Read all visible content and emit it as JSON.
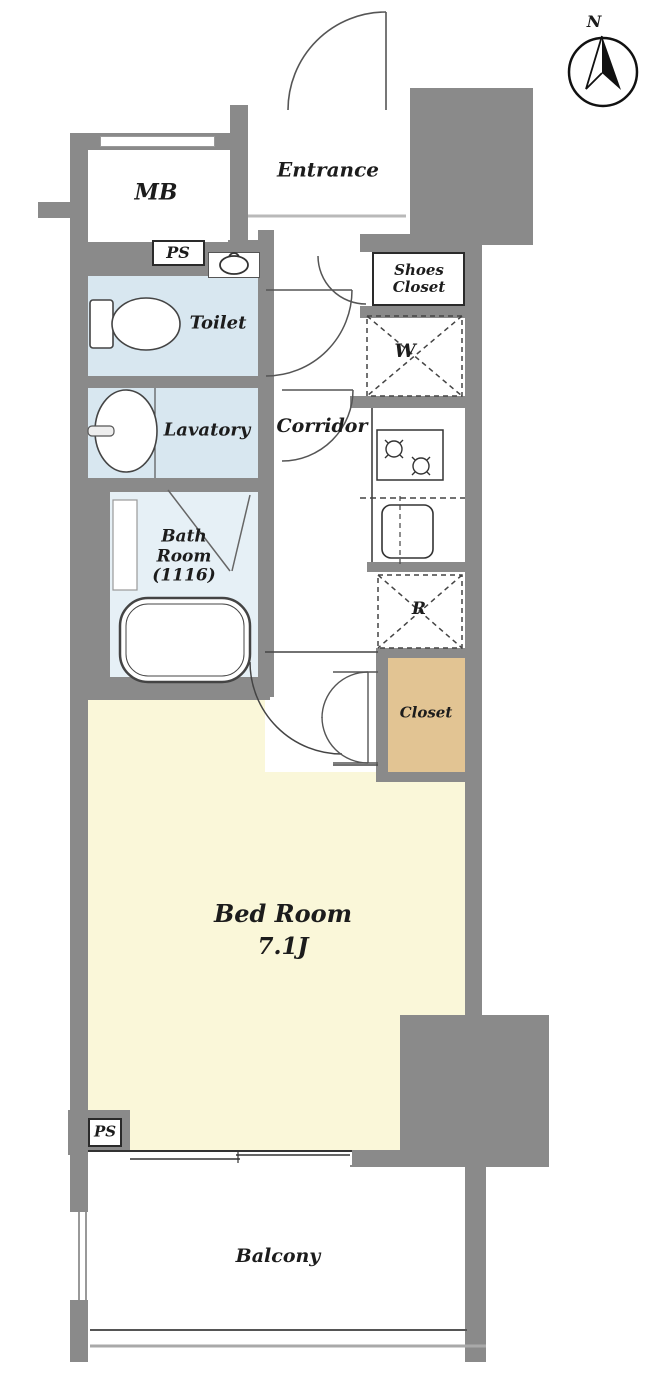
{
  "title": "Studio apartment floor plan",
  "compass": {
    "label": "N"
  },
  "labels": {
    "entrance": "Entrance",
    "mb": "MB",
    "ps_top": "PS",
    "toilet": "Toilet",
    "lavatory": "Lavatory",
    "corridor": "Corridor",
    "shoes_closet_line1": "Shoes",
    "shoes_closet_line2": "Closet",
    "washer": "W",
    "refrigerator": "R",
    "bath_line1": "Bath",
    "bath_line2": "Room",
    "bath_line3": "(1116)",
    "closet": "Closet",
    "bedroom_name": "Bed Room",
    "bedroom_size": "7.1J",
    "ps_bottom": "PS",
    "balcony": "Balcony"
  },
  "icons": {
    "compass_needle": "north-arrow",
    "water_heater": "water-heater",
    "toilet_fixture": "toilet-bowl",
    "lavatory_fixture": "wash-basin",
    "bath_fixture": "bathtub",
    "kitchen_stove": "two-burner-stove",
    "kitchen_sink": "sink",
    "washer_space": "washing-machine-space",
    "fridge_space": "refrigerator-space"
  },
  "colors": {
    "wall": "#8a8a8a",
    "water_room": "#d8e7f0",
    "bath_room": "#e6f0f6",
    "bedroom": "#faf7d9",
    "closet": "#e2c493",
    "line": "#333333"
  }
}
